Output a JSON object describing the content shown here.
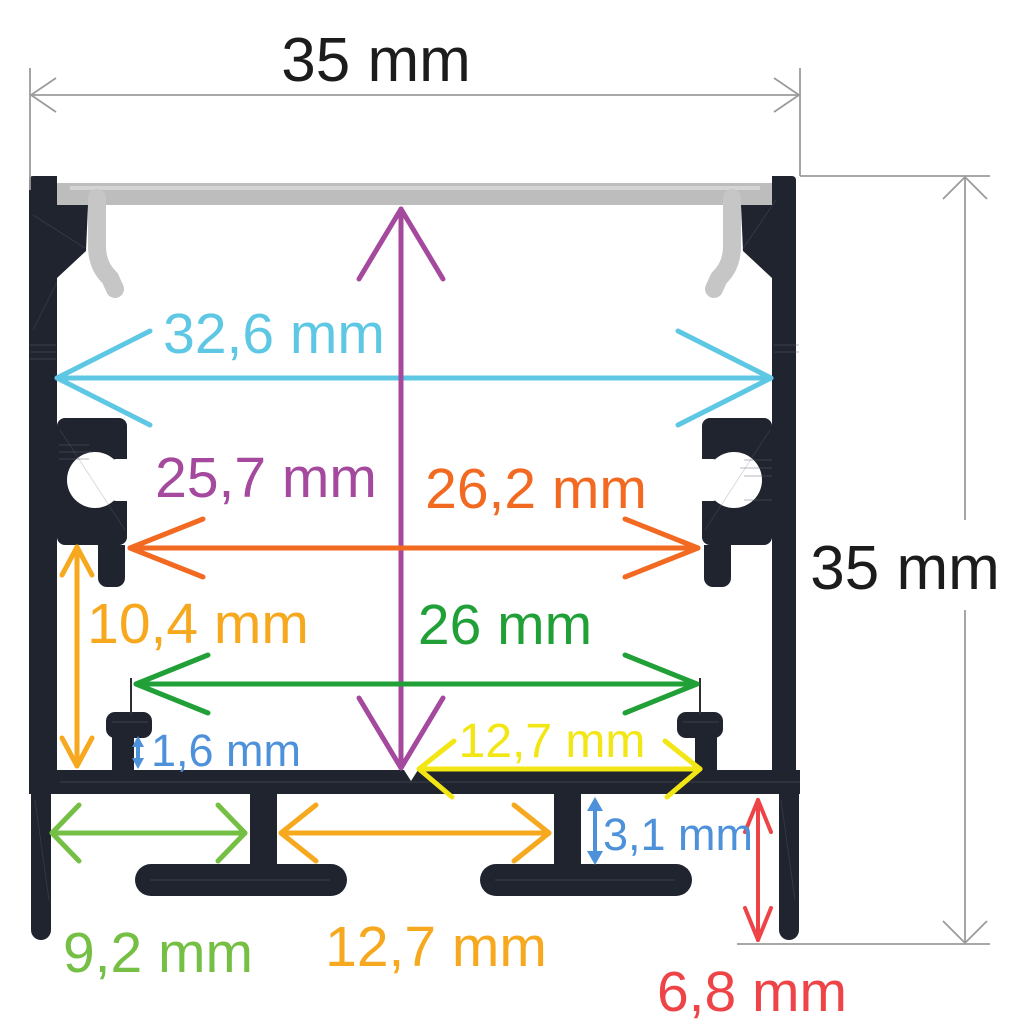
{
  "drawing": {
    "type": "technical-cross-section",
    "subject": "Surface-mounted aluminium LED strip profile with diffuser, dimensioned 35 mm x 35 mm",
    "units": "mm"
  },
  "colors": {
    "background": "#ffffff",
    "profile": "#20242e",
    "diffuser": "#bdbdbd",
    "diffuser_clip": "#c6c6c6",
    "dim_lines": "#9b9b9b"
  },
  "dims": {
    "outer_width": {
      "label": "35 mm",
      "color": "#1c1c1c"
    },
    "outer_height": {
      "label": "35 mm",
      "color": "#1c1c1c"
    },
    "inner_width": {
      "label": "32,6 mm",
      "color": "#5ec8e4"
    },
    "inner_height": {
      "label": "25,7 mm",
      "color": "#a4499d"
    },
    "groove_width": {
      "label": "26,2 mm",
      "color": "#f26a22"
    },
    "ledge_height": {
      "label": "10,4 mm",
      "color": "#f6a81e"
    },
    "pin_span": {
      "label": "26 mm",
      "color": "#21a038"
    },
    "pin_step": {
      "label": "1,6 mm",
      "color": "#4d91da"
    },
    "half_width": {
      "label": "12,7 mm",
      "color": "#f2e614"
    },
    "foot_gap": {
      "label": "9,2 mm",
      "color": "#74bf44"
    },
    "foot_pitch": {
      "label": "12,7 mm",
      "color": "#f6a81e"
    },
    "foot_height": {
      "label": "3,1 mm",
      "color": "#4d91da"
    },
    "leg_height": {
      "label": "6,8 mm",
      "color": "#ee4347"
    }
  }
}
